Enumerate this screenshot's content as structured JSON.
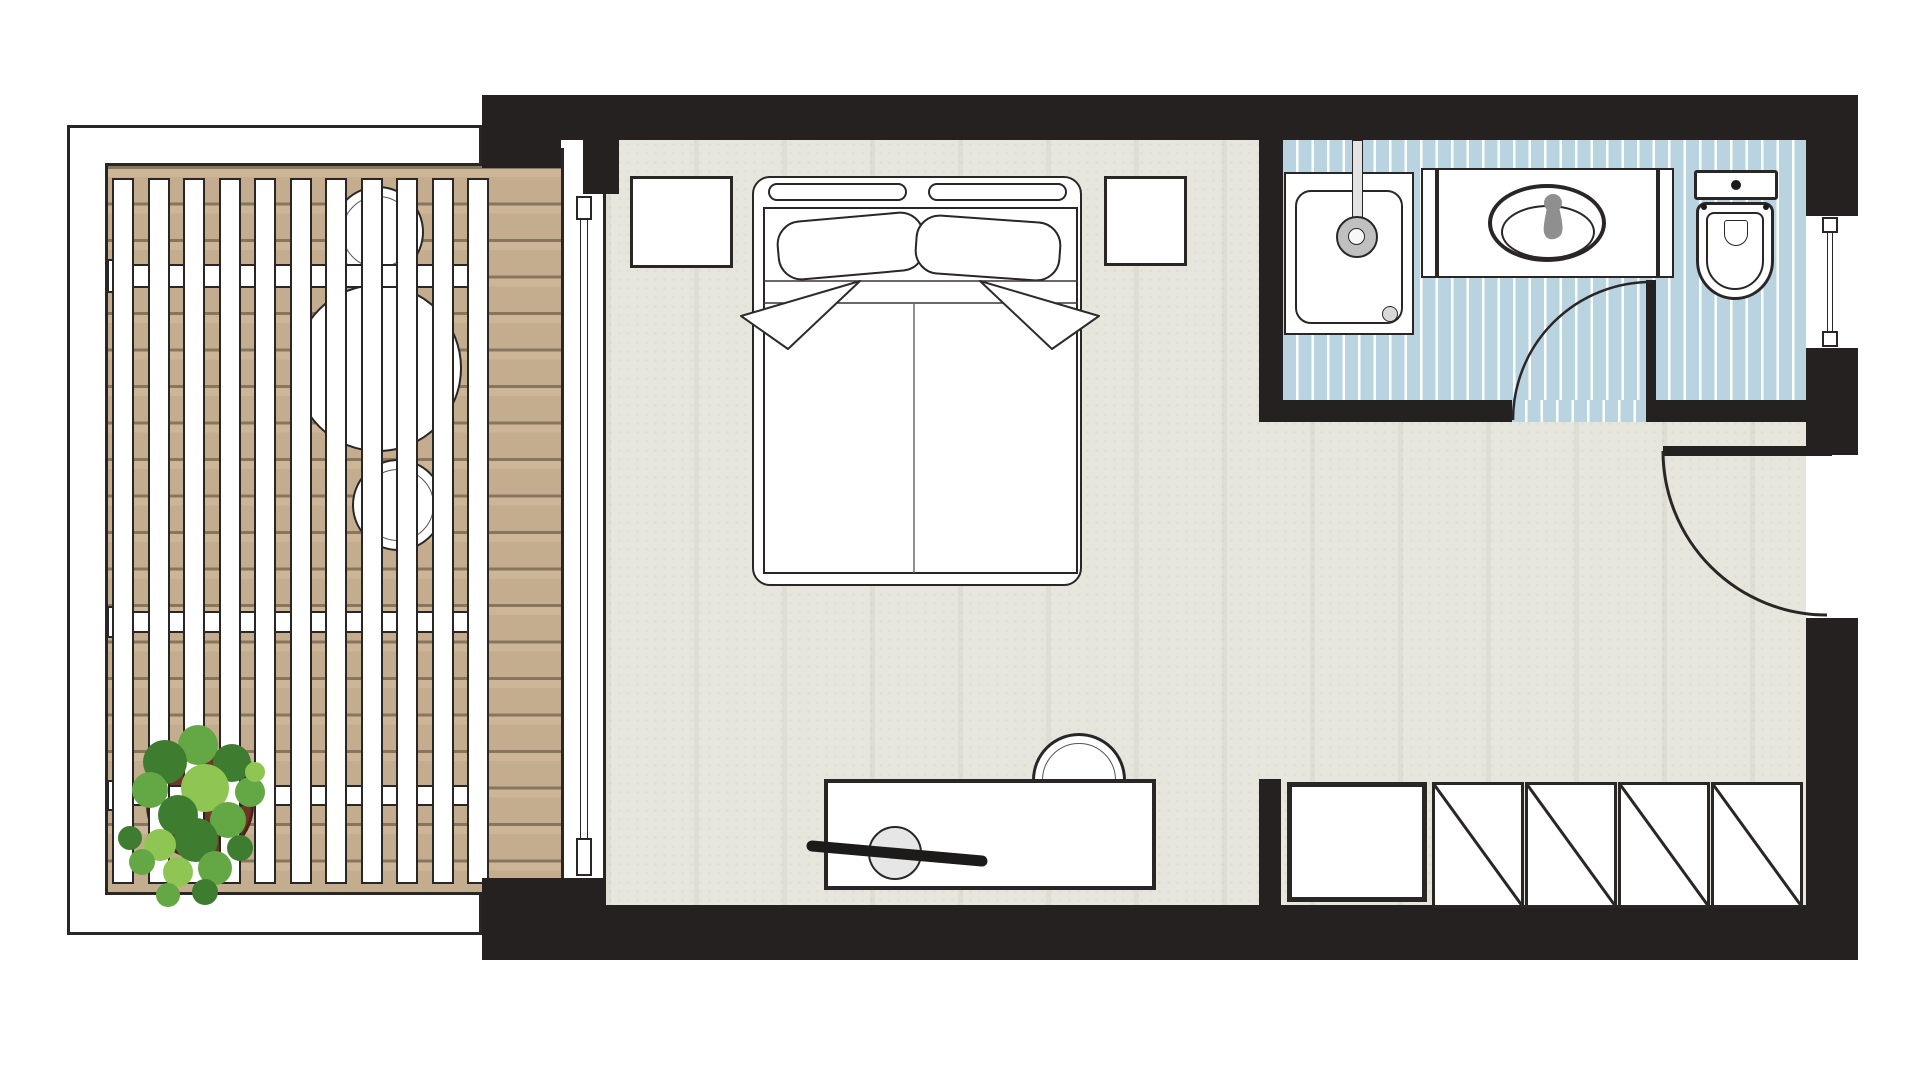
{
  "meta": {
    "document_type": "floor-plan",
    "description": "Hotel room floor plan: wooden pergola terrace (left), bedroom with double bed and desk (center), bathroom with shower, vanity and toilet (top right), entry hall with wardrobe (bottom right)",
    "visible_text": []
  },
  "palette": {
    "wall": "#262121",
    "outline": "#2b2626",
    "white": "#ffffff",
    "floor_base": "#e6e6dd",
    "deck_base": "#c4ad8f",
    "deck_line": "#87765d",
    "bath_blue": "#b9d3e1",
    "bath_stripe": "#fbfdfe",
    "fixture_gray": "#8f8f8f",
    "stool_gray": "#e6e6e6",
    "pot_brown": "#6f3526",
    "greens": [
      "#3e7c2f",
      "#63a844",
      "#8fc653"
    ]
  },
  "rooms": [
    {
      "id": "terrace",
      "label": "terrace with pergola and deck"
    },
    {
      "id": "bedroom",
      "label": "bedroom"
    },
    {
      "id": "bathroom",
      "label": "bathroom"
    },
    {
      "id": "entry",
      "label": "entry hall with wardrobe"
    }
  ],
  "shapes": [
    {
      "n": "terrace-frame",
      "t": "rect",
      "x": 67,
      "y": 125,
      "w": 415,
      "h": 810,
      "bg": "#ffffff",
      "bw": 3
    },
    {
      "n": "terrace-deck",
      "t": "rect",
      "x": 105,
      "y": 163,
      "w": 456,
      "h": 732,
      "cls": "deck",
      "bw": 3,
      "sides": "ltb"
    },
    {
      "n": "terrace-chair-top",
      "t": "circ",
      "cx": 378,
      "cy": 232,
      "r": 46,
      "bg": "#ffffff",
      "bw": 2.5
    },
    {
      "n": "terrace-chair-top-ring",
      "t": "circ",
      "cx": 378,
      "cy": 232,
      "r": 36,
      "bg": "none",
      "bw": 1.5,
      "bc": "#555555"
    },
    {
      "n": "terrace-chair-bottom",
      "t": "circ",
      "cx": 398,
      "cy": 505,
      "r": 46,
      "bg": "#ffffff",
      "bw": 2.5
    },
    {
      "n": "terrace-chair-bottom-ring",
      "t": "circ",
      "cx": 398,
      "cy": 505,
      "r": 36,
      "bg": "none",
      "bw": 1.5,
      "bc": "#555555"
    },
    {
      "n": "terrace-table",
      "t": "circ",
      "cx": 378,
      "cy": 368,
      "r": 84,
      "bg": "#ffffff",
      "bw": 2.5
    },
    {
      "n": "plant-pot",
      "t": "circ",
      "cx": 200,
      "cy": 805,
      "r": 54,
      "bg": "#6f3526",
      "bw": 3,
      "bc": "#4e2318"
    },
    {
      "n": "pergola-beam-tab",
      "t": "rect",
      "x": 107,
      "y": 259,
      "w": 26,
      "h": 34,
      "bg": "#ffffff",
      "bw": 2.5
    },
    {
      "n": "pergola-beam",
      "t": "rect",
      "x": 128,
      "y": 264,
      "w": 350,
      "h": 24,
      "bg": "#ffffff",
      "bw": 2.5
    },
    {
      "n": "pergola-beam-tab",
      "t": "rect",
      "x": 107,
      "y": 606,
      "w": 26,
      "h": 32,
      "bg": "#ffffff",
      "bw": 2.5
    },
    {
      "n": "pergola-beam",
      "t": "rect",
      "x": 128,
      "y": 611,
      "w": 350,
      "h": 22,
      "bg": "#ffffff",
      "bw": 2.5
    },
    {
      "n": "pergola-beam-tab",
      "t": "rect",
      "x": 107,
      "y": 780,
      "w": 26,
      "h": 31,
      "bg": "#ffffff",
      "bw": 2.5
    },
    {
      "n": "pergola-beam",
      "t": "rect",
      "x": 128,
      "y": 785,
      "w": 350,
      "h": 21,
      "bg": "#ffffff",
      "bw": 2.5
    },
    {
      "n": "pergola-slat",
      "t": "rep",
      "from": 112,
      "step": 35.5,
      "count": 11,
      "y": 178,
      "w": 22,
      "h": 706,
      "bg": "#ffffff",
      "bw": 2.5
    },
    {
      "n": "plant-foliage",
      "t": "blobs",
      "items": [
        [
          198,
          745,
          20,
          1
        ],
        [
          165,
          762,
          22,
          0
        ],
        [
          232,
          763,
          19,
          0
        ],
        [
          150,
          790,
          18,
          1
        ],
        [
          250,
          792,
          15,
          1
        ],
        [
          205,
          788,
          24,
          2
        ],
        [
          178,
          815,
          20,
          0
        ],
        [
          228,
          820,
          18,
          1
        ],
        [
          196,
          840,
          22,
          0
        ],
        [
          160,
          845,
          16,
          2
        ],
        [
          240,
          848,
          13,
          0
        ],
        [
          215,
          868,
          17,
          1
        ],
        [
          178,
          872,
          15,
          2
        ],
        [
          142,
          862,
          13,
          1
        ],
        [
          255,
          772,
          10,
          2
        ],
        [
          130,
          838,
          12,
          0
        ],
        [
          205,
          892,
          13,
          0
        ],
        [
          168,
          895,
          12,
          1
        ]
      ]
    },
    {
      "n": "bedroom-floor",
      "t": "rect",
      "x": 606,
      "y": 140,
      "w": 1200,
      "h": 765,
      "cls": "floor"
    },
    {
      "n": "bathroom-floor",
      "t": "rect",
      "x": 1283,
      "y": 140,
      "w": 523,
      "h": 260,
      "cls": "bath"
    },
    {
      "n": "bathroom-door-threshold",
      "t": "rect",
      "x": 1512,
      "y": 400,
      "w": 144,
      "h": 22,
      "cls": "bath"
    },
    {
      "n": "terrace-door-frame",
      "t": "rect",
      "x": 561,
      "y": 148,
      "w": 45,
      "h": 757,
      "bg": "#ffffff",
      "bw": 3,
      "sides": "lr"
    },
    {
      "n": "terrace-door-glass",
      "t": "rect",
      "x": 580,
      "y": 218,
      "w": 8,
      "h": 622,
      "bg": "#ffffff",
      "bw": 1.5,
      "sides": "lr"
    },
    {
      "n": "terrace-door-stop-top",
      "t": "rect",
      "x": 576,
      "y": 196,
      "w": 16,
      "h": 24,
      "bg": "#ffffff",
      "bw": 2
    },
    {
      "n": "terrace-door-stop-bottom",
      "t": "rect",
      "x": 576,
      "y": 838,
      "w": 16,
      "h": 38,
      "bg": "#ffffff",
      "bw": 2
    },
    {
      "n": "wall-top",
      "t": "rect",
      "x": 482,
      "y": 95,
      "w": 1376,
      "h": 45,
      "cls": "wall"
    },
    {
      "n": "wall-terrace-pier",
      "t": "rect",
      "x": 482,
      "y": 95,
      "w": 79,
      "h": 73,
      "cls": "wall"
    },
    {
      "n": "wall-door-pocket",
      "t": "rect",
      "x": 583,
      "y": 140,
      "w": 36,
      "h": 54,
      "cls": "wall"
    },
    {
      "n": "wall-bathroom-left",
      "t": "rect",
      "x": 1259,
      "y": 95,
      "w": 24,
      "h": 327,
      "cls": "wall"
    },
    {
      "n": "wall-bathroom-bottom-left",
      "t": "rect",
      "x": 1283,
      "y": 400,
      "w": 229,
      "h": 22,
      "cls": "wall"
    },
    {
      "n": "wall-bathroom-bottom-right",
      "t": "rect",
      "x": 1656,
      "y": 400,
      "w": 150,
      "h": 22,
      "cls": "wall"
    },
    {
      "n": "wall-right-top",
      "t": "rect",
      "x": 1806,
      "y": 95,
      "w": 52,
      "h": 121,
      "cls": "wall"
    },
    {
      "n": "wall-right-mid",
      "t": "rect",
      "x": 1806,
      "y": 348,
      "w": 52,
      "h": 107,
      "cls": "wall"
    },
    {
      "n": "wall-right-bottom",
      "t": "rect",
      "x": 1806,
      "y": 618,
      "w": 52,
      "h": 342,
      "cls": "wall"
    },
    {
      "n": "wall-bottom",
      "t": "rect",
      "x": 606,
      "y": 905,
      "w": 1252,
      "h": 55,
      "cls": "wall"
    },
    {
      "n": "wall-bottom-terrace-corner",
      "t": "rect",
      "x": 482,
      "y": 878,
      "w": 124,
      "h": 82,
      "cls": "wall"
    },
    {
      "n": "wall-entry-stub",
      "t": "rect",
      "x": 1259,
      "y": 779,
      "w": 22,
      "h": 126,
      "cls": "wall"
    },
    {
      "n": "shower-tray",
      "t": "rect",
      "x": 1284,
      "y": 172,
      "w": 130,
      "h": 163,
      "bg": "#ffffff",
      "bw": 2.5
    },
    {
      "n": "shower-tray-inner",
      "t": "rect",
      "x": 1295,
      "y": 190,
      "w": 108,
      "h": 134,
      "bg": "#ffffff",
      "bw": 2,
      "br": "16px"
    },
    {
      "n": "shower-drain",
      "t": "circ",
      "cx": 1390,
      "cy": 314,
      "r": 8,
      "bg": "#d9d9d9",
      "bw": 1.5
    },
    {
      "n": "shower-arm",
      "t": "rect",
      "x": 1352,
      "y": 140,
      "w": 11,
      "h": 95,
      "bg": "#e3e3e3",
      "bw": 1.5
    },
    {
      "n": "shower-head",
      "t": "circ",
      "cx": 1357,
      "cy": 237,
      "r": 21,
      "bg": "#c0c0c0",
      "bw": 2
    },
    {
      "n": "shower-head-center",
      "t": "circ",
      "cx": 1356,
      "cy": 236,
      "r": 8.5,
      "bg": "#f7f7f7",
      "bw": 1
    },
    {
      "n": "vanity-wall-stub-left",
      "t": "rect",
      "x": 1421,
      "y": 168,
      "w": 16,
      "h": 110,
      "bg": "#ffffff",
      "bw": 2.5
    },
    {
      "n": "vanity-counter",
      "t": "rect",
      "x": 1437,
      "y": 168,
      "w": 221,
      "h": 110,
      "bg": "#ffffff",
      "bw": 2.5
    },
    {
      "n": "vanity-wall-stub-right",
      "t": "rect",
      "x": 1658,
      "y": 168,
      "w": 16,
      "h": 110,
      "bg": "#ffffff",
      "bw": 2.5
    },
    {
      "n": "sink-basin-outer",
      "t": "ell",
      "cx": 1547,
      "cy": 223,
      "rx": 59,
      "ry": 39,
      "bg": "#ffffff",
      "bw": 4
    },
    {
      "n": "sink-basin-inner",
      "t": "ell",
      "cx": 1548,
      "cy": 232,
      "rx": 47,
      "ry": 27,
      "bg": "#ffffff",
      "bw": 2.5
    },
    {
      "n": "toilet-tank",
      "t": "rect",
      "x": 1694,
      "y": 170,
      "w": 84,
      "h": 30,
      "bg": "#ffffff",
      "bw": 3,
      "br": "3px"
    },
    {
      "n": "toilet-flush-button",
      "t": "circ",
      "cx": 1736,
      "cy": 185,
      "r": 5,
      "bg": "#1d1a1a",
      "bw": 0
    },
    {
      "n": "toilet-bowl",
      "t": "rect",
      "x": 1696,
      "y": 202,
      "w": 78,
      "h": 98,
      "bg": "#ffffff",
      "bw": 3.5,
      "br": "10px 10px 39px 39px"
    },
    {
      "n": "toilet-seat-inner",
      "t": "rect",
      "x": 1706,
      "y": 212,
      "w": 58,
      "h": 78,
      "bg": "none",
      "bw": 2,
      "br": "8px 8px 29px 29px"
    },
    {
      "n": "toilet-bowl-detail",
      "t": "rect",
      "x": 1724,
      "y": 220,
      "w": 24,
      "h": 26,
      "bg": "none",
      "bw": 1.5,
      "br": "3px 3px 12px 12px"
    },
    {
      "n": "toilet-hinge-left",
      "t": "circ",
      "cx": 1704,
      "cy": 207,
      "r": 3,
      "bg": "#1d1a1a",
      "bw": 0
    },
    {
      "n": "toilet-hinge-right",
      "t": "circ",
      "cx": 1766,
      "cy": 207,
      "r": 3,
      "bg": "#1d1a1a",
      "bw": 0
    },
    {
      "n": "bathroom-door-leaf",
      "t": "rect",
      "x": 1646,
      "y": 280,
      "w": 10,
      "h": 142,
      "cls": "wall"
    },
    {
      "n": "window-recess",
      "t": "rect",
      "x": 1806,
      "y": 216,
      "w": 52,
      "h": 132,
      "bg": "#ffffff",
      "bw": 0
    },
    {
      "n": "window-glass",
      "t": "rect",
      "x": 1827,
      "y": 233,
      "w": 6,
      "h": 98,
      "bg": "#ffffff",
      "bw": 1.5,
      "sides": "lr"
    },
    {
      "n": "window-stop-top",
      "t": "rect",
      "x": 1822,
      "y": 217,
      "w": 16,
      "h": 16,
      "bg": "#ffffff",
      "bw": 2
    },
    {
      "n": "window-stop-bottom",
      "t": "rect",
      "x": 1822,
      "y": 331,
      "w": 16,
      "h": 16,
      "bg": "#ffffff",
      "bw": 2
    },
    {
      "n": "entry-door-leaf",
      "t": "rect",
      "x": 1663,
      "y": 446,
      "w": 169,
      "h": 10,
      "cls": "wall"
    },
    {
      "n": "bed-frame",
      "t": "rect",
      "x": 752,
      "y": 176,
      "w": 330,
      "h": 410,
      "bg": "#ffffff",
      "bw": 2.5,
      "br": "18px"
    },
    {
      "n": "headboard-cushion-left",
      "t": "rect",
      "x": 768,
      "y": 183,
      "w": 139,
      "h": 18,
      "bg": "#ffffff",
      "bw": 2,
      "br": "9px"
    },
    {
      "n": "headboard-cushion-right",
      "t": "rect",
      "x": 928,
      "y": 183,
      "w": 139,
      "h": 18,
      "bg": "#ffffff",
      "bw": 2,
      "br": "9px"
    },
    {
      "n": "mattress",
      "t": "rect",
      "x": 763,
      "y": 207,
      "w": 315,
      "h": 367,
      "bg": "#ffffff",
      "bw": 2
    },
    {
      "n": "pillow-left",
      "t": "rect",
      "x": 777,
      "y": 216,
      "w": 148,
      "h": 60,
      "bg": "#ffffff",
      "bw": 2,
      "br": "24px",
      "rot": -5
    },
    {
      "n": "pillow-right",
      "t": "rect",
      "x": 915,
      "y": 218,
      "w": 146,
      "h": 60,
      "bg": "#ffffff",
      "bw": 2,
      "br": "24px",
      "rot": 4
    },
    {
      "n": "nightstand-left",
      "t": "rect",
      "x": 630,
      "y": 176,
      "w": 103,
      "h": 92,
      "bg": "#ffffff",
      "bw": 3
    },
    {
      "n": "nightstand-right",
      "t": "rect",
      "x": 1104,
      "y": 176,
      "w": 83,
      "h": 90,
      "bg": "#ffffff",
      "bw": 3
    },
    {
      "n": "desk-chair",
      "t": "circ",
      "cx": 1079,
      "cy": 780,
      "r": 47,
      "bg": "#ffffff",
      "bw": 3
    },
    {
      "n": "desk-chair-ring",
      "t": "circ",
      "cx": 1079,
      "cy": 780,
      "r": 37,
      "bg": "none",
      "bw": 1.5,
      "bc": "#555555"
    },
    {
      "n": "desk",
      "t": "rect",
      "x": 824,
      "y": 779,
      "w": 332,
      "h": 111,
      "bg": "#ffffff",
      "bw": 4
    },
    {
      "n": "desk-stool",
      "t": "circ",
      "cx": 895,
      "cy": 853,
      "r": 27,
      "bg": "#e6e6e6",
      "bw": 2.5
    },
    {
      "n": "wardrobe-shelf-unit",
      "t": "rect",
      "x": 1287,
      "y": 782,
      "w": 140,
      "h": 120,
      "bg": "#ffffff",
      "bw": 5
    },
    {
      "n": "wardrobe-door",
      "t": "rect",
      "x": 1432,
      "y": 782,
      "w": 92,
      "h": 126,
      "bg": "#ffffff",
      "bw": 3
    },
    {
      "n": "wardrobe-door",
      "t": "rect",
      "x": 1525,
      "y": 782,
      "w": 92,
      "h": 126,
      "bg": "#ffffff",
      "bw": 3
    },
    {
      "n": "wardrobe-door",
      "t": "rect",
      "x": 1618,
      "y": 782,
      "w": 92,
      "h": 126,
      "bg": "#ffffff",
      "bw": 3
    },
    {
      "n": "wardrobe-door",
      "t": "rect",
      "x": 1711,
      "y": 782,
      "w": 92,
      "h": 126,
      "bg": "#ffffff",
      "bw": 3
    }
  ],
  "svg": [
    {
      "n": "duvet-top-line",
      "t": "line",
      "x1": 763,
      "y1": 281,
      "x2": 1078,
      "y2": 281,
      "sw": 1.5,
      "sc": "#3a3535"
    },
    {
      "n": "duvet-cuff-line",
      "t": "line",
      "x1": 763,
      "y1": 303,
      "x2": 1078,
      "y2": 303,
      "sw": 1.5,
      "sc": "#3a3535"
    },
    {
      "n": "duvet-center-line",
      "t": "line",
      "x1": 914,
      "y1": 303,
      "x2": 914,
      "y2": 573,
      "sw": 1.5,
      "sc": "#6a6a6a"
    },
    {
      "n": "duvet-fold-left",
      "t": "poly",
      "pts": "860,281 741,316 788,349",
      "fill": "#ffffff",
      "sw": 2,
      "sc": "#2f2b2b"
    },
    {
      "n": "duvet-fold-right",
      "t": "poly",
      "pts": "980,281 1099,316 1052,349",
      "fill": "#ffffff",
      "sw": 2,
      "sc": "#2f2b2b"
    },
    {
      "n": "faucet-knob",
      "t": "circle",
      "cx": 1553,
      "cy": 203,
      "r": 9,
      "fill": "#8f8f8f",
      "sw": 0
    },
    {
      "n": "faucet-spout",
      "t": "path",
      "d": "M1547,207 L1559,207 C1563,224 1564,232 1560,236 C1554,241 1547,240 1545,235 C1542,230 1545,219 1547,207 Z",
      "fill": "#8f8f8f",
      "sw": 0
    },
    {
      "n": "bathroom-door-swing-arc",
      "t": "path",
      "d": "M1651,282 A138,138 0 0 0 1513,420",
      "fill": "none",
      "sw": 2.5,
      "sc": "#2b2626"
    },
    {
      "n": "entry-door-swing-arc",
      "t": "path",
      "d": "M1663,451 A164,164 0 0 0 1827,615",
      "fill": "none",
      "sw": 3,
      "sc": "#2b2626"
    },
    {
      "n": "desk-pen",
      "t": "line",
      "x1": 812,
      "y1": 846,
      "x2": 982,
      "y2": 861,
      "sw": 11,
      "sc": "#1d1a1a",
      "cap": "round"
    },
    {
      "n": "wardrobe-door-diagonal",
      "t": "line",
      "x1": 1433,
      "y1": 783,
      "x2": 1523,
      "y2": 907,
      "sw": 3,
      "sc": "#2b2626"
    },
    {
      "n": "wardrobe-door-diagonal",
      "t": "line",
      "x1": 1526,
      "y1": 783,
      "x2": 1616,
      "y2": 907,
      "sw": 3,
      "sc": "#2b2626"
    },
    {
      "n": "wardrobe-door-diagonal",
      "t": "line",
      "x1": 1619,
      "y1": 783,
      "x2": 1709,
      "y2": 907,
      "sw": 3,
      "sc": "#2b2626"
    },
    {
      "n": "wardrobe-door-diagonal",
      "t": "line",
      "x1": 1712,
      "y1": 783,
      "x2": 1802,
      "y2": 907,
      "sw": 3,
      "sc": "#2b2626"
    }
  ]
}
